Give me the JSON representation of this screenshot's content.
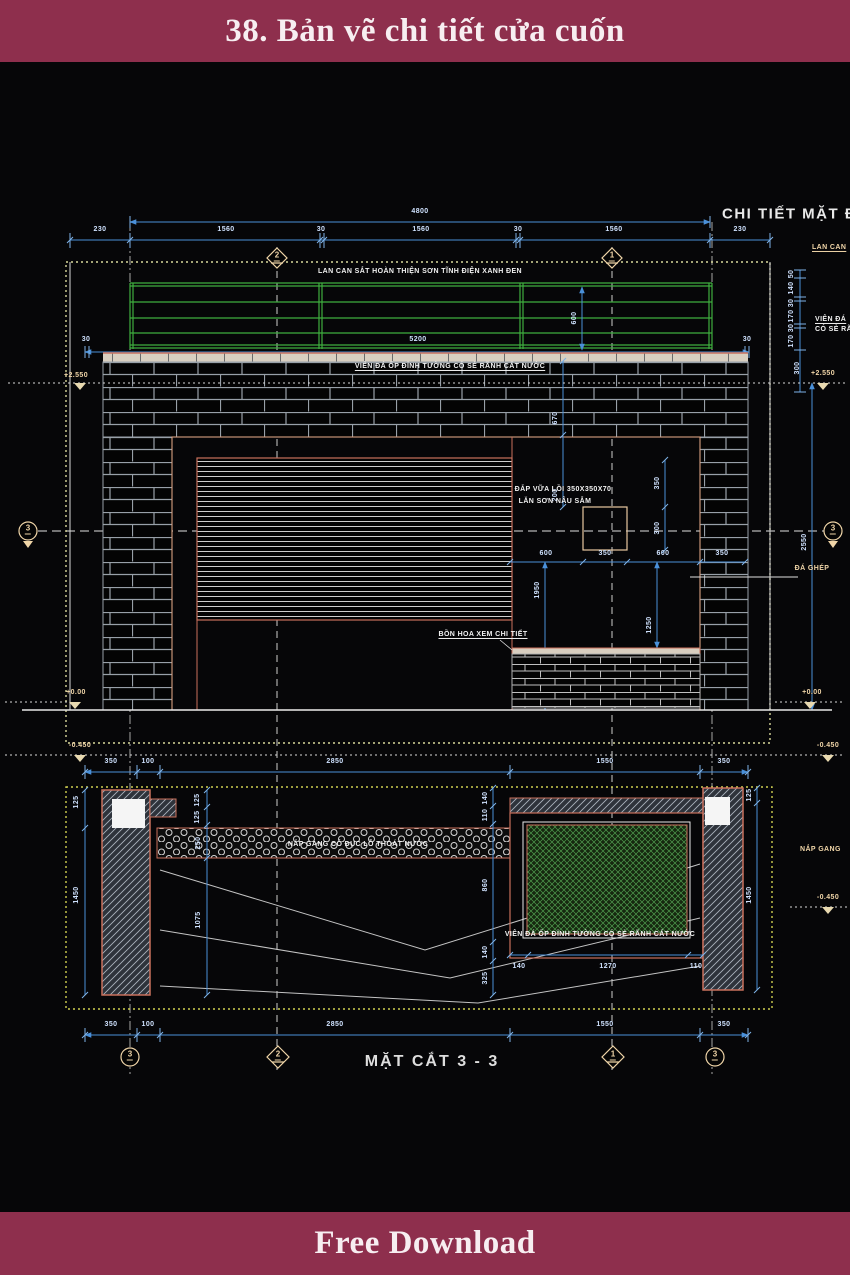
{
  "header": {
    "title": "38. Bản vẽ chi tiết cửa cuốn"
  },
  "footer": {
    "label": "Free Download"
  },
  "elev": {
    "title": "CHI TIẾT MẶT ĐỨNG",
    "railing_note": "LAN CAN SẮT HOÀN THIỆN SƠN TĨNH ĐIỆN XANH ĐEN",
    "coping_note": "VIÊN ĐÁ ỐP ĐỈNH TƯỜNG CÓ SẺ RÃNH CẮT NƯỚC",
    "mortar1": "ĐẮP VỮA LỒI 350X350X70",
    "mortar2": "LĂN SƠN NÂU SẪM",
    "planter_note": "BỒN HOA XEM CHI TIẾT",
    "stone_note": "ĐÁ GHÉP",
    "total": "4800",
    "top": [
      "230",
      "1560",
      "30",
      "1560",
      "30",
      "1560",
      "230"
    ],
    "w5200": "5200",
    "n30": "30",
    "h600": "600",
    "v670": "670",
    "v200": "200",
    "sq": [
      "600",
      "350",
      "600",
      "350"
    ],
    "v350": "350",
    "v300": "300",
    "v1950": "1950",
    "v1250": "1250",
    "v2550": "2550",
    "lv_top": "+2.550",
    "lv_zero": "+0.00",
    "lv_neg": "-0.450"
  },
  "rm": {
    "lan": "LAN CAN",
    "vd1": "VIÊN ĐÁ",
    "vd2": "CÓ SẺ RÃ",
    "nap": "NẮP GANG",
    "chain": [
      "50",
      "140",
      "30",
      "170",
      "30",
      "170"
    ],
    "v300": "300"
  },
  "mid": {
    "dims": [
      "350",
      "100",
      "2850",
      "1550",
      "350"
    ]
  },
  "sec": {
    "title": "MẶT CẮT 3 - 3",
    "grate_note": "NẮP GANG CÓ ĐỤC LỖ THOÁT NƯỚC",
    "coping_note": "VIÊN ĐÁ ỐP ĐỈNH TƯỜNG CÓ SẺ RÃNH CẮT NƯỚC",
    "bottom": [
      "350",
      "100",
      "2850",
      "1550",
      "350"
    ],
    "planter": [
      "140",
      "1270",
      "110"
    ],
    "l125": "125",
    "l1450": "1450",
    "inner": [
      "125",
      "125",
      "250",
      "1075"
    ],
    "chain": [
      "140",
      "110",
      "860",
      "140",
      "325"
    ],
    "r125": "125",
    "r1450": "1450"
  },
  "bub": {
    "b1": "1",
    "b2": "2",
    "b3": "3"
  }
}
